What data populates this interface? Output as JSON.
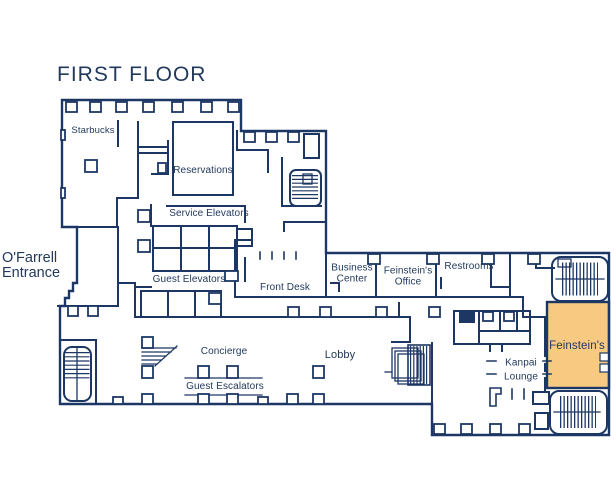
{
  "colors": {
    "wall": "#1d3764",
    "ink": "#22395c",
    "highlight": "#f7c981",
    "bg": "#ffffff"
  },
  "title": "FIRST FLOOR",
  "entrance_label": "O'Farrell\nEntrance",
  "rooms": {
    "starbucks": "Starbucks",
    "reservations": "Reservations",
    "service_elevators": "Service Elevators",
    "guest_elevators": "Guest Elevators",
    "front_desk": "Front Desk",
    "business_center": "Business\nCenter",
    "feinsteins_office": "Feinstein's\nOffice",
    "restrooms": "Restrooms",
    "concierge": "Concierge",
    "guest_escalators": "Guest Escalators",
    "lobby": "Lobby",
    "kanpai_lounge": "Kanpai\nLounge",
    "feinsteins": "Feinstein's"
  },
  "highlighted_room": "feinsteins"
}
